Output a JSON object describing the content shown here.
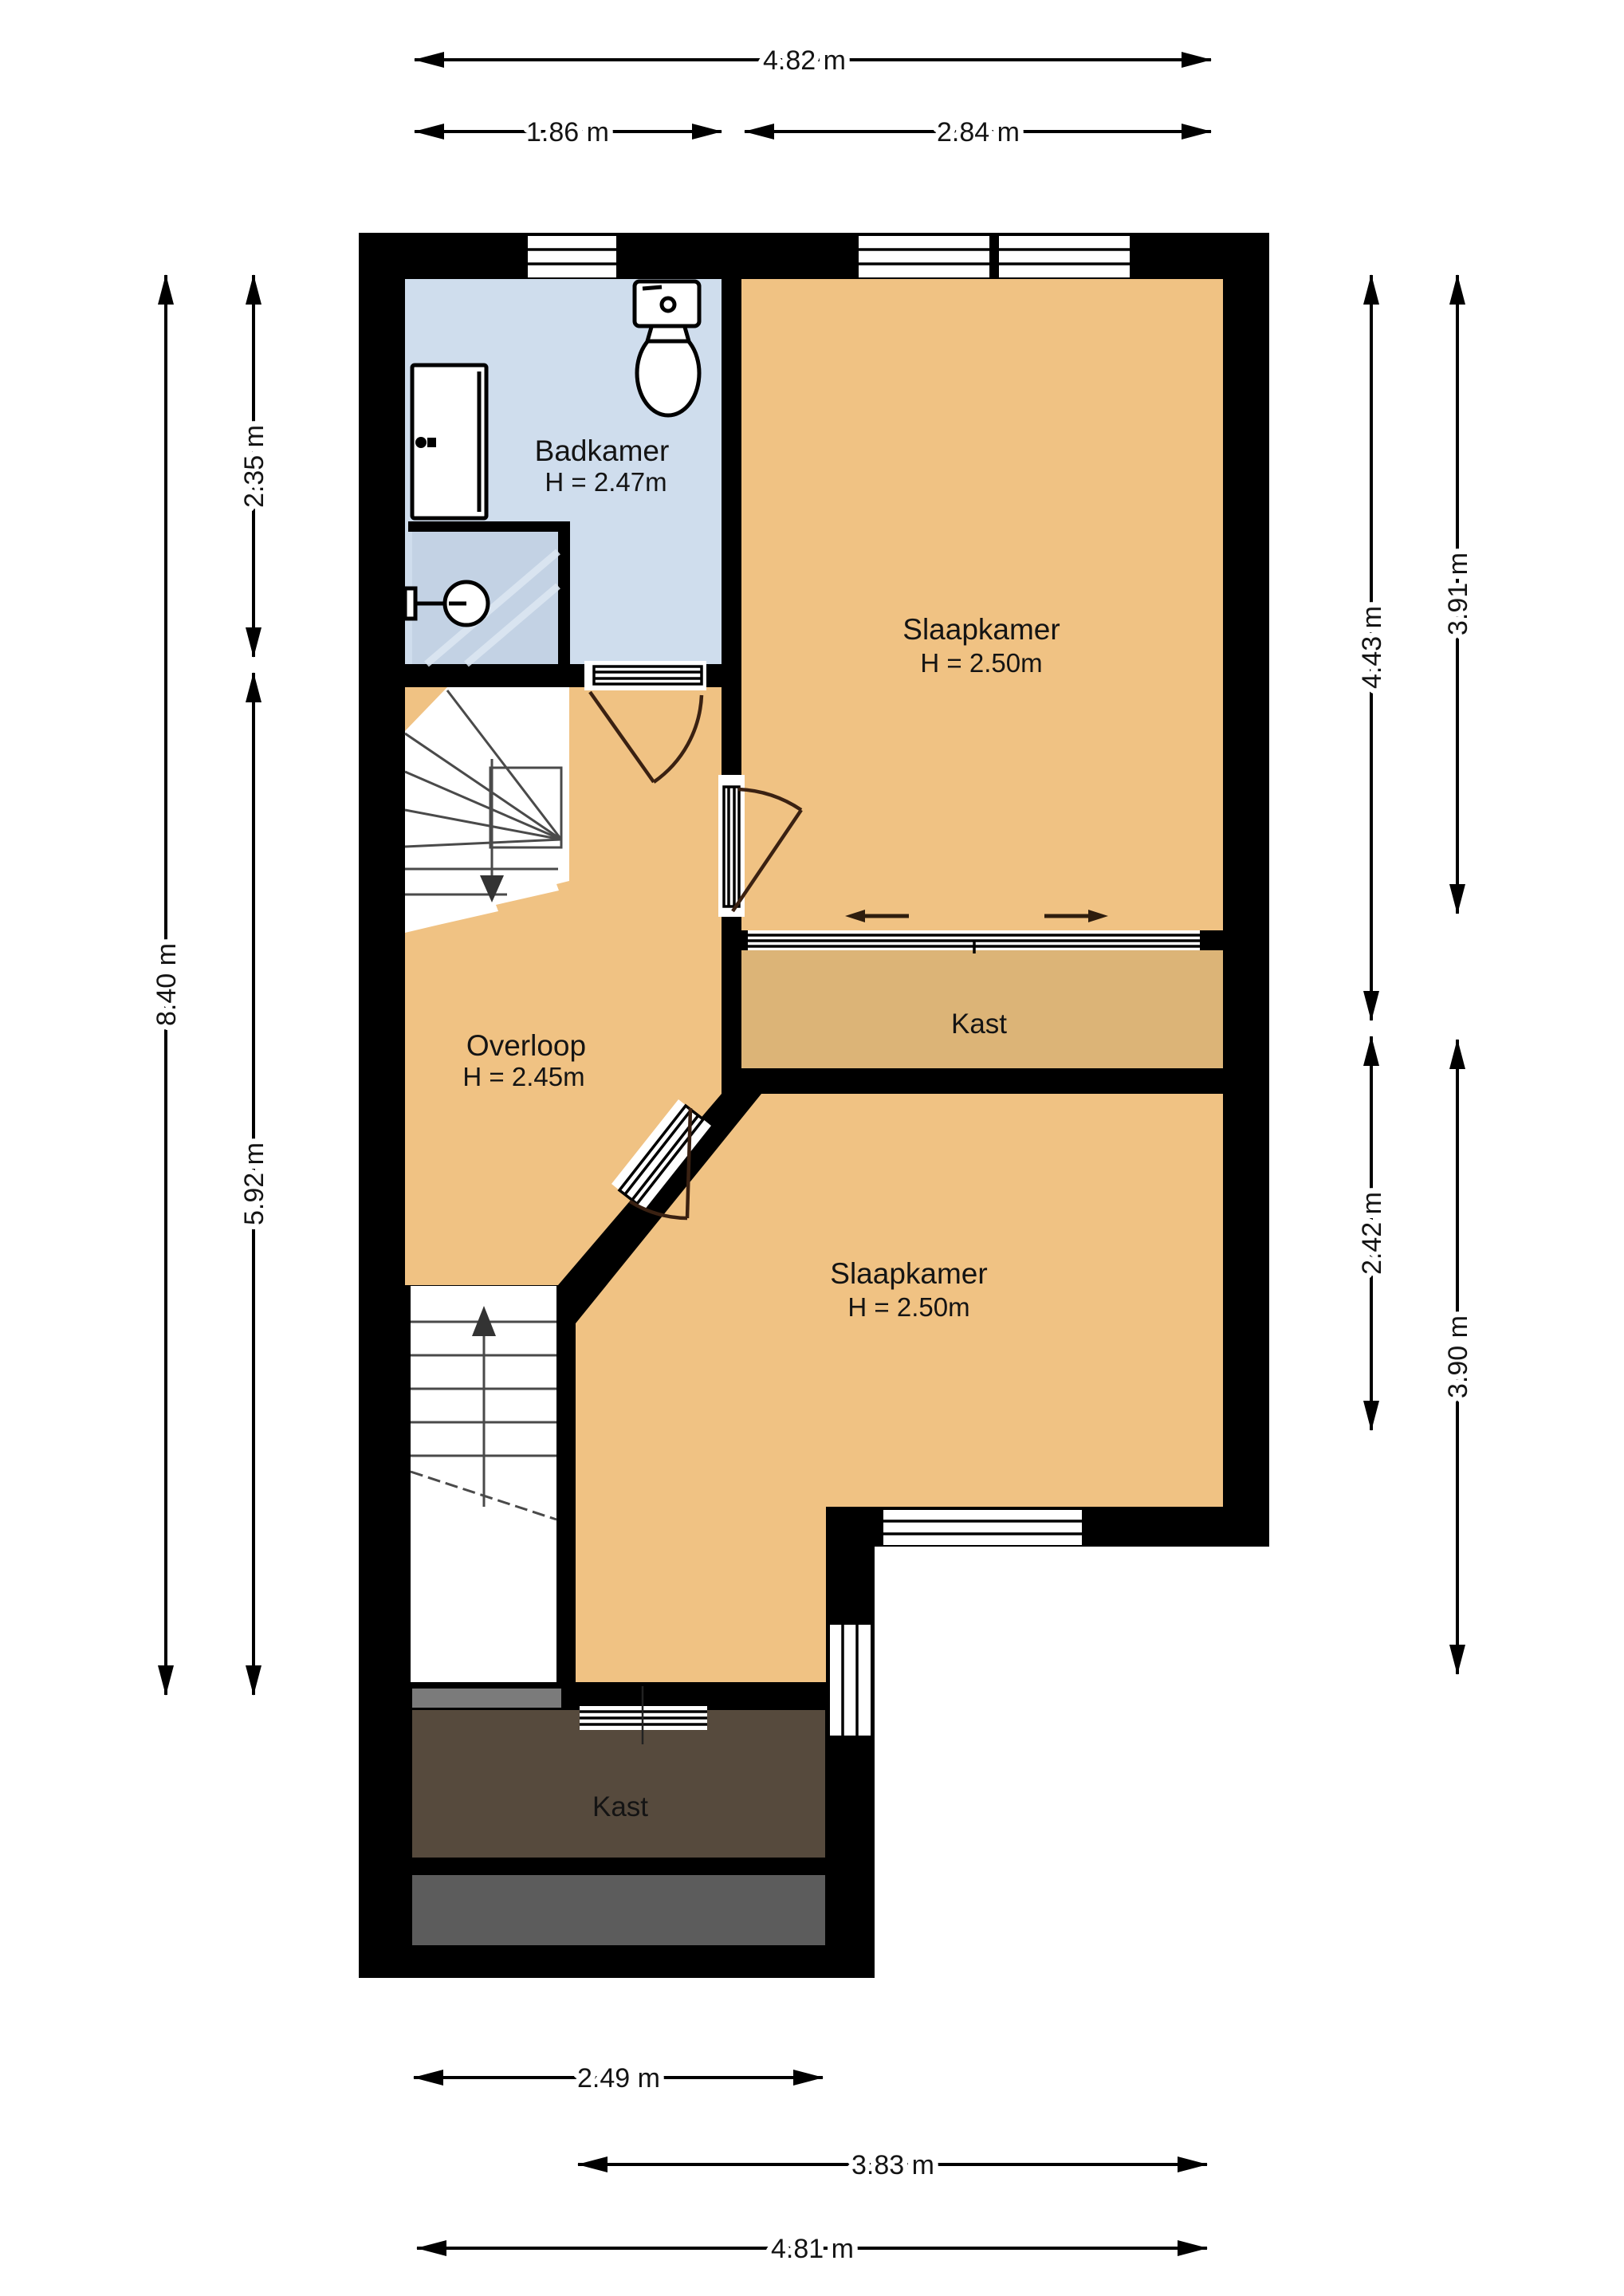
{
  "floorplan": {
    "rooms": {
      "badkamer": {
        "name": "Badkamer",
        "height": "H = 2.47m"
      },
      "slaapkamer_top": {
        "name": "Slaapkamer",
        "height": "H = 2.50m"
      },
      "overloop": {
        "name": "Overloop",
        "height": "H = 2.45m"
      },
      "kast_middle": {
        "name": "Kast"
      },
      "slaapkamer_bottom": {
        "name": "Slaapkamer",
        "height": "H = 2.50m"
      },
      "kast_bottom": {
        "name": "Kast"
      }
    },
    "dimensions": {
      "top": [
        "4.82 m",
        "1.86 m",
        "2.84 m"
      ],
      "left": [
        "8.40 m",
        "2.35 m",
        "5.92 m"
      ],
      "right": [
        "4.43 m",
        "3.91 m",
        "2.42 m",
        "3.90 m"
      ],
      "bottom": [
        "2.49 m",
        "3.83 m",
        "4.81 m"
      ]
    },
    "colors": {
      "room_orange": "#f0c283",
      "closet_tan": "#dcb477",
      "bathroom_blue": "#cfdded",
      "shower_blue": "#c3d2e4",
      "closet_brown": "#564a3d",
      "void_gray": "#5c5c5c",
      "wall_black": "#000000"
    }
  }
}
